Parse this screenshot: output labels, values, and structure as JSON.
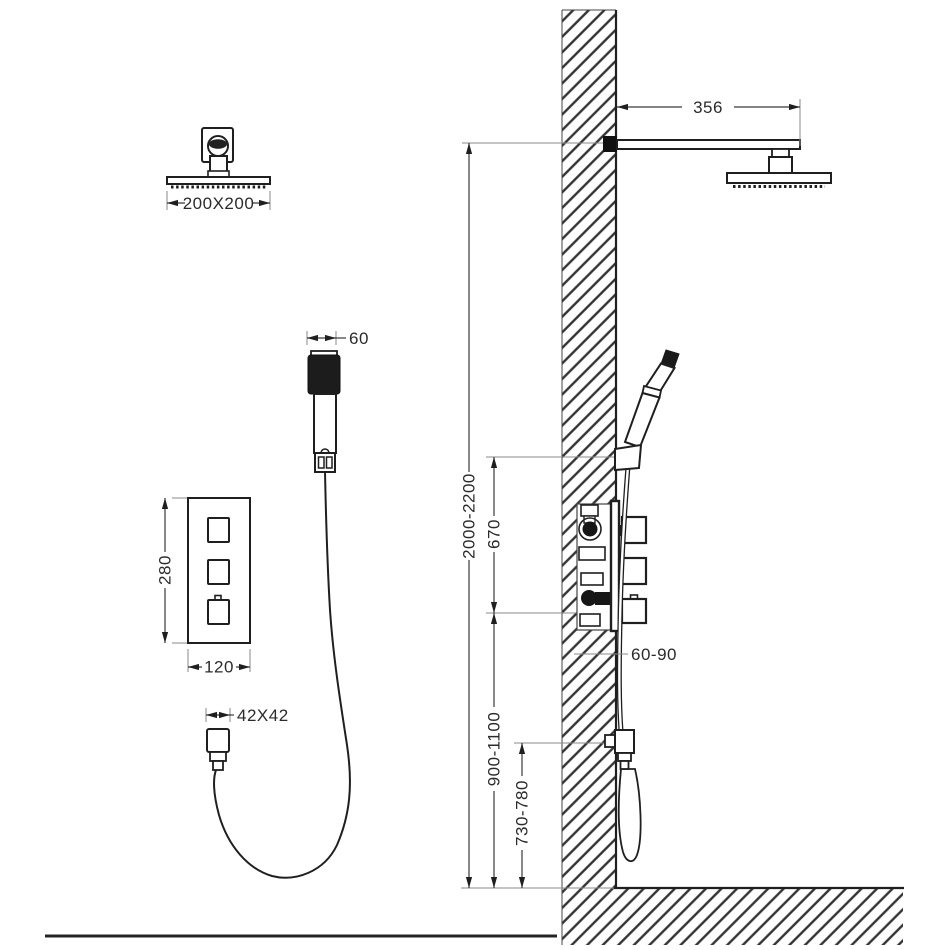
{
  "diagram": {
    "kind": "shower-system-installation-drawing",
    "labels": {
      "head_size": "200X200",
      "hand_shower_width": "60",
      "mixer_height": "280",
      "mixer_width": "120",
      "outlet_size": "42X42",
      "arm_projection": "356",
      "total_height": "2000-2200",
      "mixer_to_holder": "670",
      "recess_depth": "60-90",
      "mixer_floor_height": "900-1100",
      "outlet_floor_height": "730-780"
    }
  }
}
